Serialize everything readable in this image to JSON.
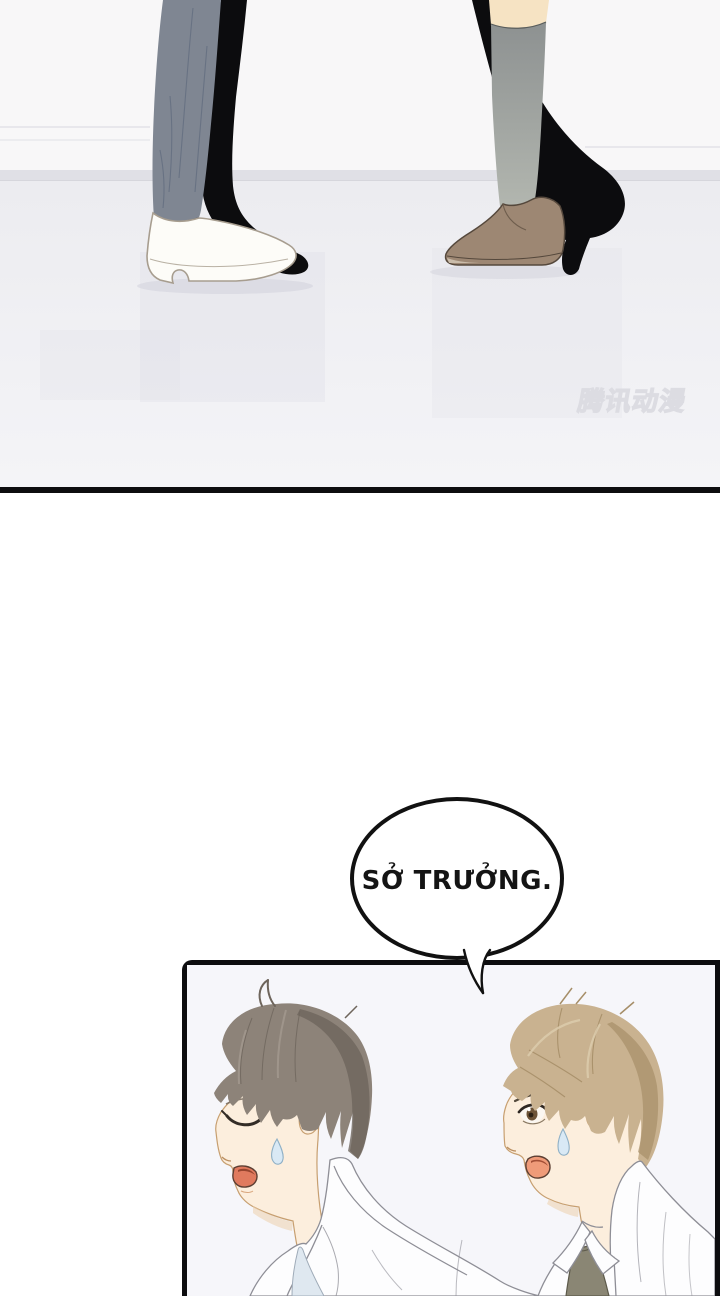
{
  "watermark": {
    "text": "腾讯动漫"
  },
  "speech_bubble": {
    "text": "SỞ TRƯỞNG."
  },
  "colors": {
    "page_bg": "#ffffff",
    "panel_border": "#0d0d0f",
    "wall": "#f8f7f8",
    "wall_line": "#e2e2e7",
    "baseboard": "#e0e0e6",
    "floor_top": "#ececf0",
    "floor_bottom": "#f4f4f7",
    "panel2_bg": "#f6f6fa",
    "ink_black": "#0c0c0e",
    "trouser_gray": "#7f8692",
    "trouser_crease": "#667082",
    "white_shoe": "#fdfcf8",
    "shoe_outline": "#a79d8f",
    "ankle_skin": "#f6e3c3",
    "sock_top": "#8d9191",
    "sock_bottom": "#b2b6af",
    "brown_shoe": "#9d8773",
    "brown_shoe_dark": "#55483c",
    "skin": "#fceedd",
    "skin_line": "#c79f70",
    "hair_left": "#8d8379",
    "hair_left_dark": "#6e655c",
    "hair_left_light": "#a49a90",
    "hair_right": "#c9b290",
    "hair_right_dark": "#a68e68",
    "hair_right_light": "#dccbad",
    "coat_white": "#fdfdfe",
    "coat_line": "#8e8e96",
    "shirt_blue": "#dfe8f0",
    "tie_olive": "#8a8674",
    "mouth_left": "#e07a5e",
    "mouth_right": "#ef9b79",
    "sweat_fill": "#d9e9f5",
    "sweat_line": "#8fb0c6",
    "bubble_fill": "#ffffff",
    "bubble_stroke": "#111111",
    "watermark_color": "#dcdce2"
  }
}
